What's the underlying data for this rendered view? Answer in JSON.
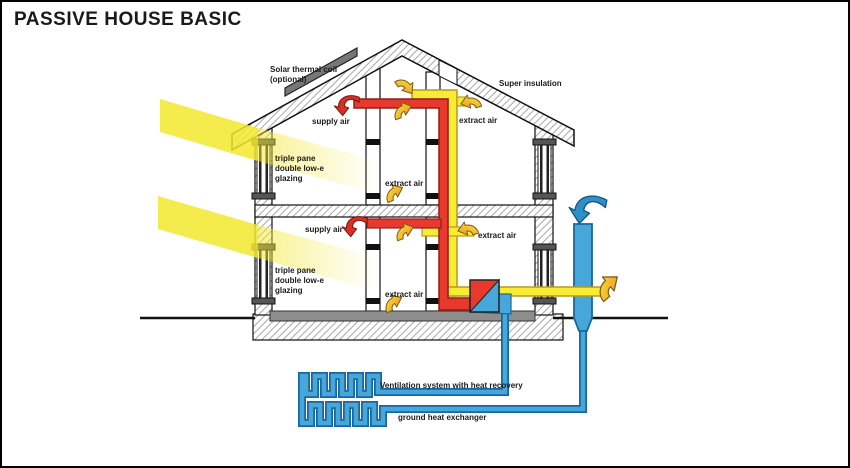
{
  "title": "PASSIVE HOUSE BASIC",
  "colors": {
    "supply_red": "#e8392f",
    "supply_red_dark": "#941f17",
    "extract_yellow": "#f7ec33",
    "extract_yellow_dark": "#b9991f",
    "fresh_air_blue": "#47a7db",
    "pipe_blue_dark": "#16689e",
    "sun_yellow": "#f2e72e",
    "slab_gray": "#8d8d8d",
    "panel_gray": "#777777"
  },
  "labels": {
    "solar_coil": [
      "Solar thermal coil",
      "(optional)"
    ],
    "super_insulation": "Super insulation",
    "attic": {
      "supply": "supply air",
      "extract": "extract air"
    },
    "upper_floor": {
      "glazing": [
        "triple pane",
        "double low-e",
        "glazing"
      ],
      "extract": "extract air"
    },
    "lower_floor": {
      "supply": "supply air",
      "extract_ceiling": "extract air",
      "glazing": [
        "triple pane",
        "double low-e",
        "glazing"
      ],
      "extract": "extract air"
    },
    "underground": {
      "ventilation": "Ventilation system with heat recovery",
      "ground_hx": "ground heat exchanger"
    }
  }
}
